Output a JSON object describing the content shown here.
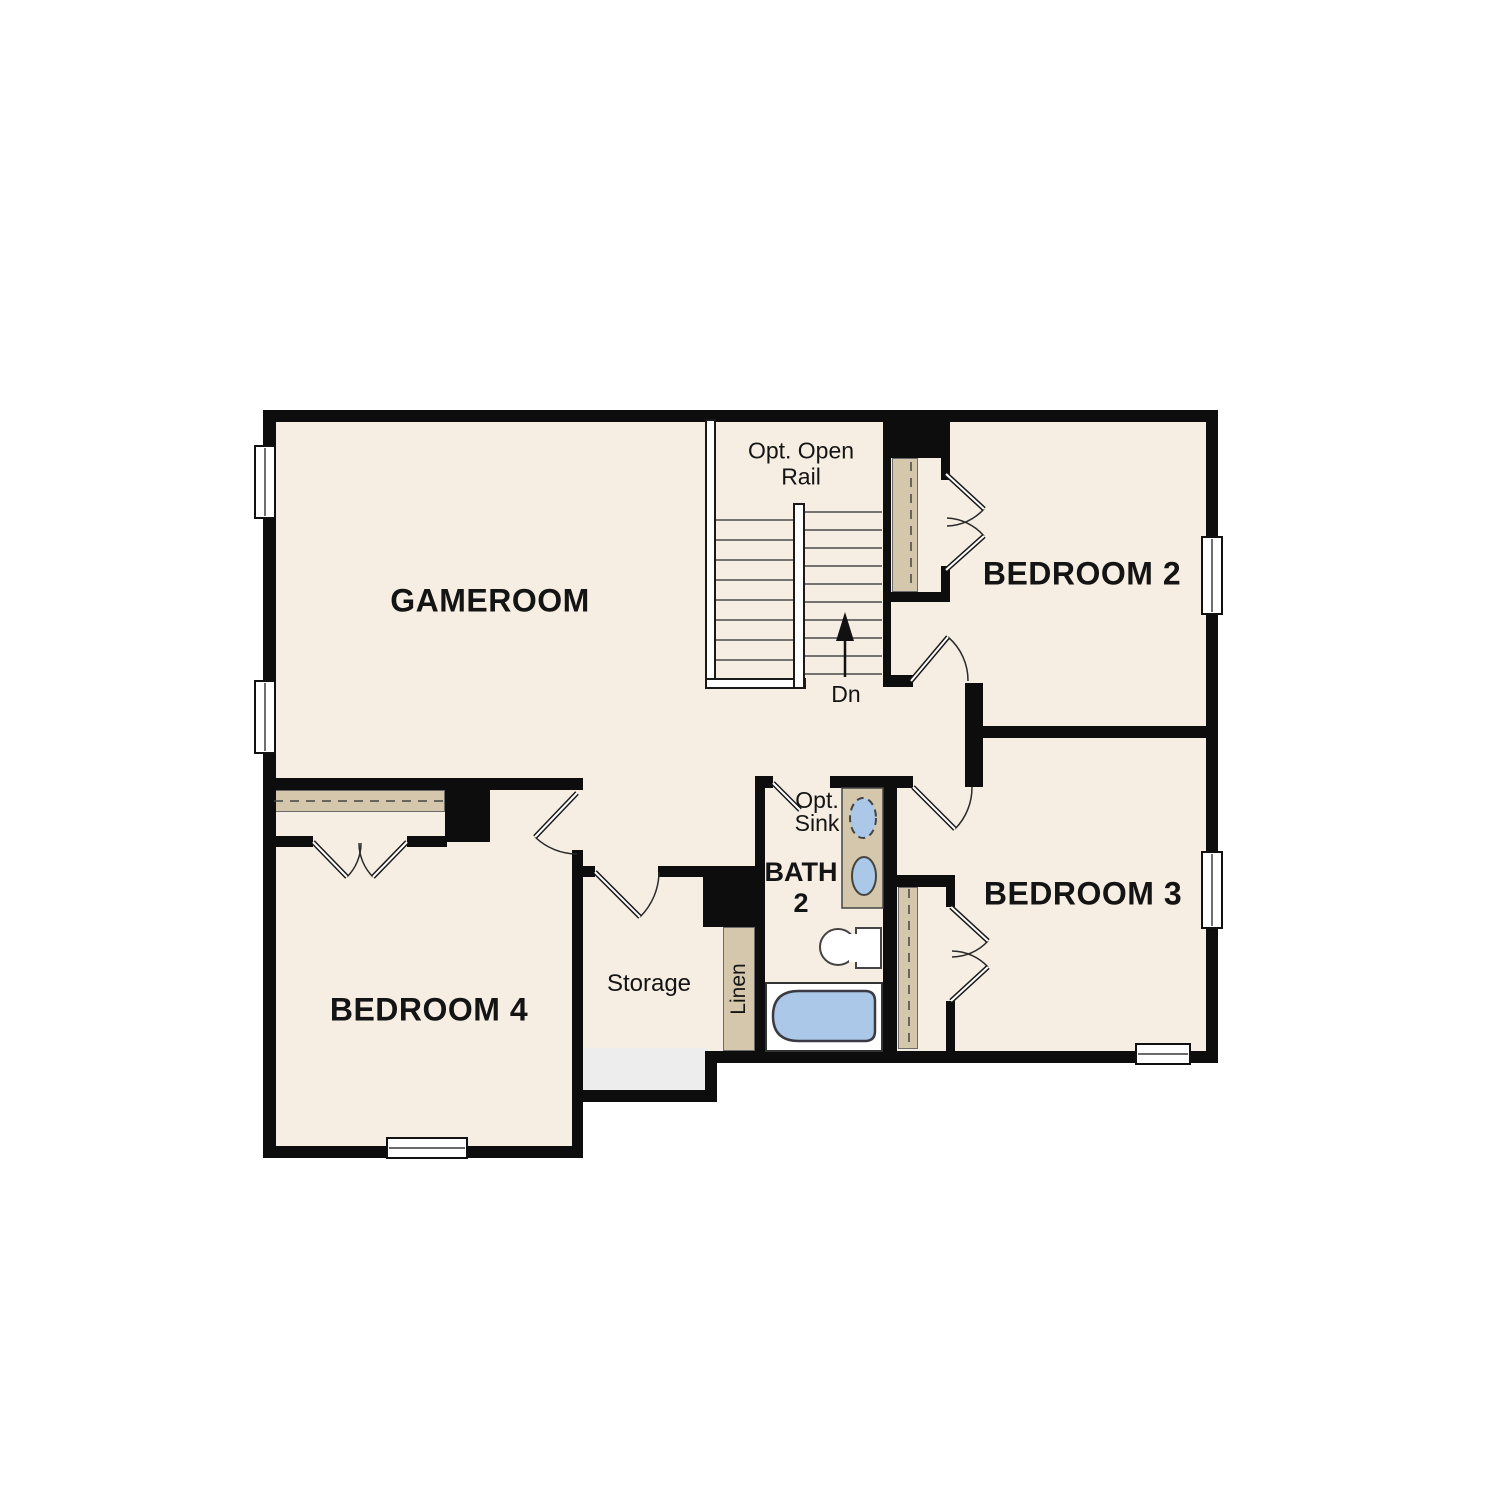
{
  "plan": {
    "rooms": {
      "gameroom": {
        "label": "GAMEROOM"
      },
      "bedroom_2": {
        "label": "BEDROOM 2"
      },
      "bedroom_3": {
        "label": "BEDROOM 3"
      },
      "bedroom_4": {
        "label": "BEDROOM 4"
      },
      "bath_2": {
        "label_line1": "BATH",
        "label_line2": "2"
      },
      "storage": {
        "label": "Storage"
      },
      "linen": {
        "label": "Linen"
      }
    },
    "stairs": {
      "optional_rail_line1": "Opt. Open",
      "optional_rail_line2": "Rail",
      "direction_label": "Dn"
    },
    "bath_fixtures": {
      "optional_sink_line1": "Opt.",
      "optional_sink_line2": "Sink"
    }
  },
  "colors": {
    "floor": "#f6eee3",
    "wall": "#0d0d0d",
    "tan": "#d4c7ab",
    "fixture_blue": "#abc8e8",
    "storage_gray": "#ededed",
    "line": "#444444"
  }
}
